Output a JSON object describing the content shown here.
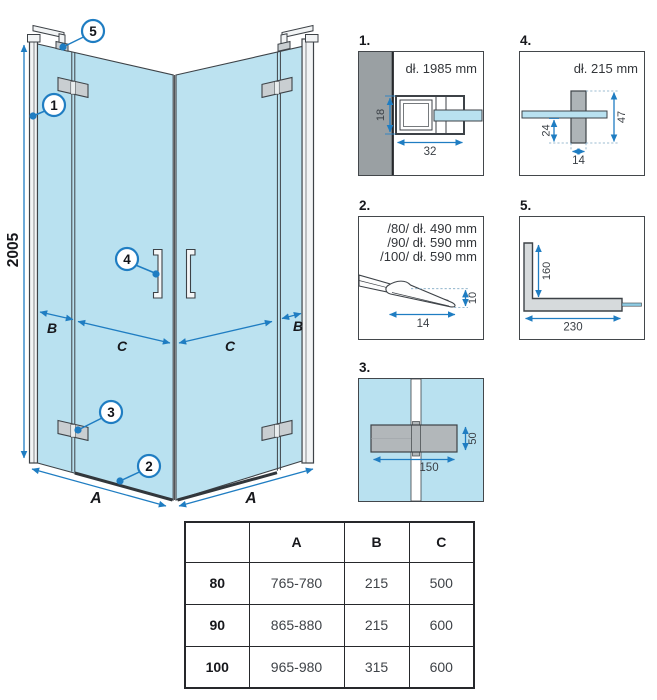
{
  "main": {
    "height_dim": "2005",
    "dim_a_left": "A",
    "dim_a_right": "A",
    "dim_b_left": "B",
    "dim_b_right": "B",
    "dim_c_left": "C",
    "dim_c_right": "C",
    "callouts": {
      "c1": "1",
      "c2": "2",
      "c3": "3",
      "c4": "4",
      "c5": "5"
    }
  },
  "details": {
    "d1": {
      "label": "1.",
      "title": "dł. 1985 mm",
      "dim_height": "18",
      "dim_width": "32"
    },
    "d2": {
      "label": "2.",
      "size_80": "/80/ dł. 490 mm",
      "size_90": "/90/ dł. 590 mm",
      "size_100": "/100/ dł. 590 mm",
      "dim_width": "14",
      "dim_height": "10"
    },
    "d3": {
      "label": "3.",
      "dim_width": "150",
      "dim_height": "50"
    },
    "d4": {
      "label": "4.",
      "title": "dł. 215 mm",
      "dim_offset": "24",
      "dim_height": "47",
      "dim_width": "14"
    },
    "d5": {
      "label": "5.",
      "dim_vertical": "160",
      "dim_horizontal": "230"
    }
  },
  "table": {
    "headers": [
      "",
      "A",
      "B",
      "C"
    ],
    "rows": [
      [
        "80",
        "765-780",
        "215",
        "500"
      ],
      [
        "90",
        "865-880",
        "215",
        "600"
      ],
      [
        "100",
        "965-980",
        "315",
        "600"
      ]
    ]
  },
  "colors": {
    "glass": "#b9e1f0",
    "dimension_blue": "#1f7dc2",
    "outline": "#3d4247",
    "profile_gray": "#c9ced1",
    "wall_gray": "#9aa0a3"
  }
}
